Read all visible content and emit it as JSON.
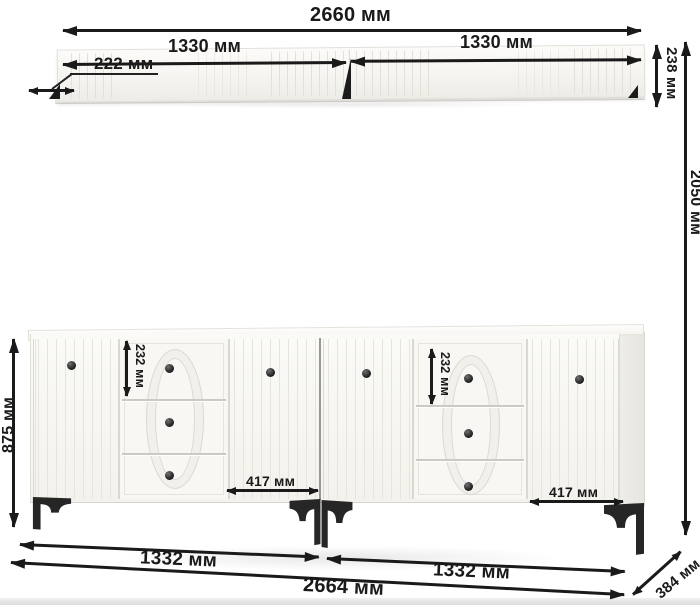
{
  "diagram": {
    "kind": "furniture-dimension-diagram",
    "units": "мм",
    "shelf": {
      "label": "wall-shelf",
      "dimensions": {
        "total_width": "2660 мм",
        "left_section": "1330 мм",
        "right_section": "1330 мм",
        "depth": "222 мм",
        "height": "238 мм"
      }
    },
    "set": {
      "total_height": "2050 мм"
    },
    "sideboard": {
      "label": "sideboard",
      "door_count": 4,
      "drawer_count": 6,
      "dimensions": {
        "height": "875 мм",
        "top_drawer_height_left": "232 мм",
        "top_drawer_height_right": "232 мм",
        "door_width_left": "417 мм",
        "door_width_right": "417 мм",
        "left_section": "1332 мм",
        "right_section": "1332 мм",
        "total_width": "2664 мм",
        "depth": "384 мм"
      }
    },
    "colors": {
      "dimension_ink": "#1a1a1a",
      "furniture_body": "#f7f5f1",
      "legs": "#262626",
      "knobs": "#262626",
      "background": "#ffffff"
    }
  }
}
